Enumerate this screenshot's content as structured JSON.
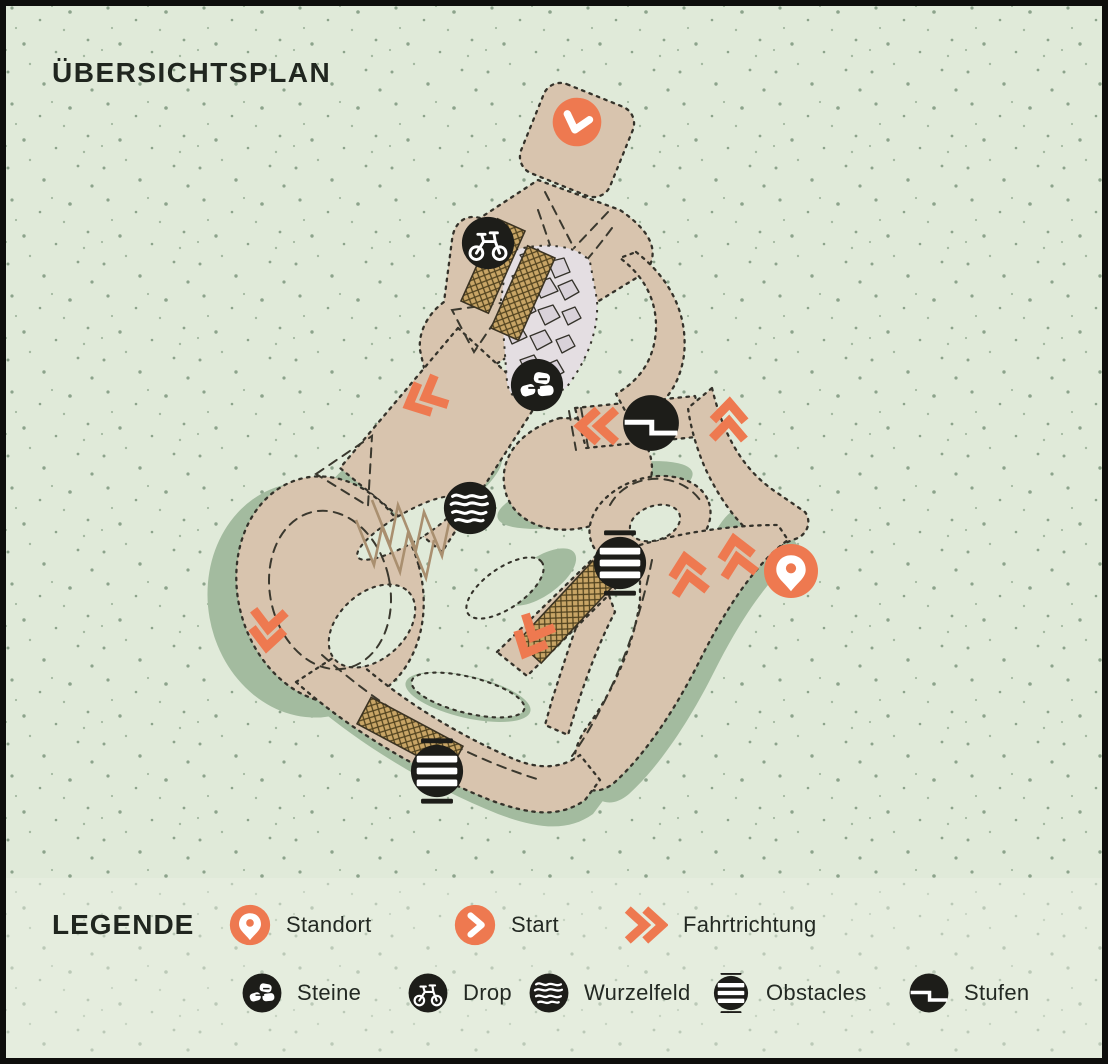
{
  "title": "ÜBERSICHTSPLAN",
  "legend": {
    "heading": "LEGENDE",
    "row1": [
      {
        "label": "Standort",
        "icon": "location-pin-icon"
      },
      {
        "label": "Start",
        "icon": "start-circle-icon"
      },
      {
        "label": "Fahrtrichtung",
        "icon": "direction-chevrons-icon"
      }
    ],
    "row2": [
      {
        "label": "Steine",
        "icon": "stones-icon"
      },
      {
        "label": "Drop",
        "icon": "drop-bike-icon"
      },
      {
        "label": "Wurzelfeld",
        "icon": "rootfield-icon"
      },
      {
        "label": "Obstacles",
        "icon": "obstacles-icon"
      },
      {
        "label": "Stufen",
        "icon": "steps-icon"
      }
    ]
  },
  "map": {
    "markers": [
      "start-circle-icon",
      "drop-bike-icon",
      "stones-icon",
      "rootfield-icon",
      "steps-icon",
      "obstacles-icon",
      "obstacles-icon",
      "location-pin-icon"
    ],
    "direction_arrow_count": 7
  },
  "colors": {
    "background": "#E0EAD9",
    "trail": "#D8C4AE",
    "shadow": "#A3BB9F",
    "accent_orange": "#EE7950",
    "icon_black": "#1D1D19",
    "ramp_wood": "#C8A566",
    "rock_grey": "#D9D2D9",
    "outline": "#34322A"
  }
}
